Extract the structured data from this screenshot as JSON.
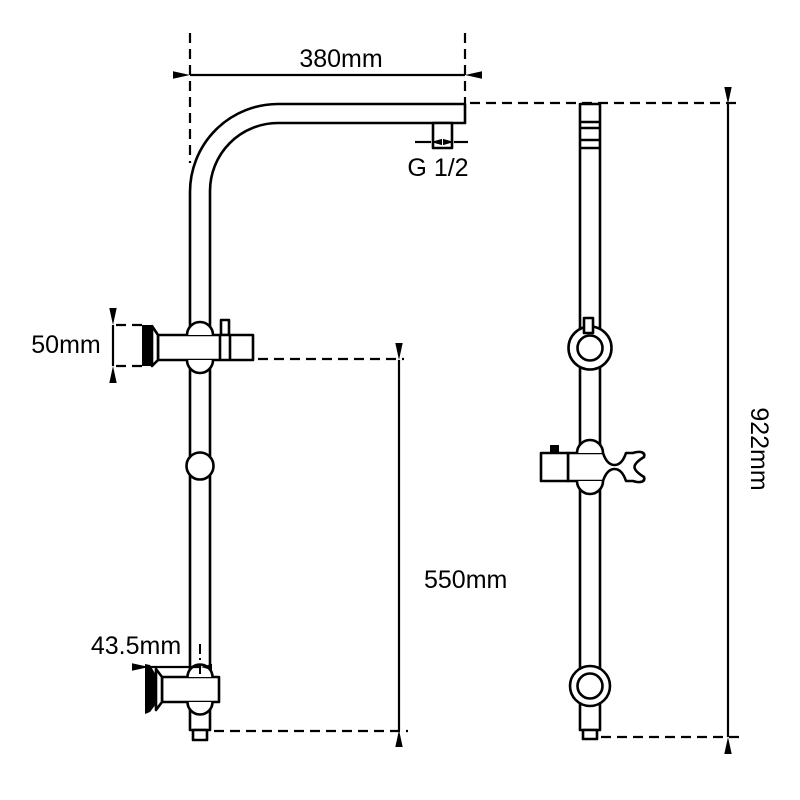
{
  "drawing": {
    "type": "technical dimension drawing",
    "subject": "shower rail column with curved top arm, wall brackets, slider knob and handset holder",
    "views": [
      "front view",
      "side view"
    ]
  },
  "labels": {
    "arm_width": "380mm",
    "inlet_thread": "G 1/2",
    "top_bracket_height": "50mm",
    "lower_span": "550mm",
    "wall_clearance": "43.5mm",
    "overall_height": "922mm"
  },
  "colors": {
    "line": "#000000",
    "background": "#ffffff"
  }
}
